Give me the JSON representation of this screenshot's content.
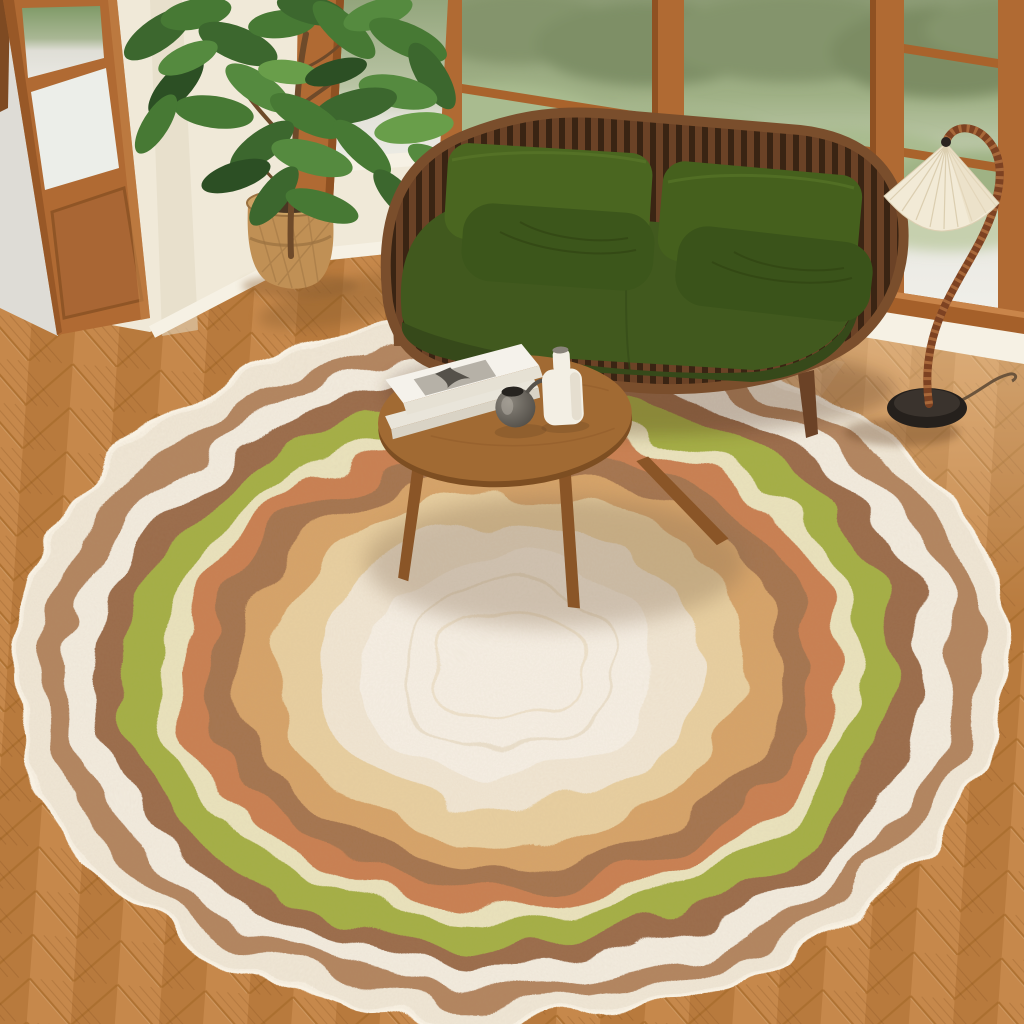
{
  "meta": {
    "description": "Top-down photo of a mid-century living room: green spindle-frame sofa by wood-framed windows, walnut oval coffee table with books and vases, pleated floor lamp, potted plant in a woven basket, open wooden french door, herringbone wood floor, and a large organic-shaped rug with wavy concentric rings in cream, brown, green and terracotta."
  },
  "palette": {
    "wall": "#f0e9d8",
    "baseboard": "#f6f1e4",
    "floor": "#c28140",
    "floor_seam": "#a96d2e",
    "wood_frame": "#b06a33",
    "wood_frame_dark": "#8f5122",
    "sill_wood": "#a5602a",
    "outdoor_path": "#dedcd6",
    "foliage_far": "#84946c",
    "foliage_bush": "#a9bb8f",
    "grass": "#7f9a67"
  },
  "rug": {
    "shape": "organic wavy oval",
    "rings": [
      {
        "name": "border-cream",
        "color": "#f0e7d6"
      },
      {
        "name": "taupe",
        "color": "#b2845f"
      },
      {
        "name": "cream",
        "color": "#f3ecdf"
      },
      {
        "name": "chestnut-brown",
        "color": "#9a6b4a"
      },
      {
        "name": "olive-green",
        "color": "#a4af44"
      },
      {
        "name": "pale-yellow",
        "color": "#eae3bd"
      },
      {
        "name": "terracotta",
        "color": "#c97f50"
      },
      {
        "name": "brown",
        "color": "#a4744e"
      },
      {
        "name": "tan-gold",
        "color": "#d6a368"
      },
      {
        "name": "buff",
        "color": "#e8cfa0"
      },
      {
        "name": "inner-cream",
        "color": "#f1e6d3"
      },
      {
        "name": "ivory-center",
        "color": "#f6efe4"
      }
    ]
  },
  "sofa": {
    "frame_color": "#6b4226",
    "slat_dark": "#3a2413",
    "rail_color": "#7a4e2c",
    "cushion_color": "#41591e",
    "cushion_shadow": "#36491a",
    "back_pillow_color": "#4a6620",
    "back_pillow_color_right": "#45601d",
    "lumbar_pillow_color": "#3c561b",
    "lumbar_pillow_color_right": "#3a531a"
  },
  "coffee_table": {
    "top_color": "#a16a33",
    "edge_color": "#7d4e22",
    "leg_color": "#8a5527",
    "items": {
      "books": {
        "cover_color": "#f5f2eb",
        "photo_color": "#b6b1a7"
      },
      "pewter_vase": {
        "color": "#55524d"
      },
      "bottle_vase": {
        "color": "#f3efe4"
      }
    }
  },
  "floor_lamp": {
    "base_color": "#25201c",
    "stem_color": "#7d4222",
    "stem_bead_color": "#a8683a",
    "shade_color": "#f2ead6"
  },
  "plant": {
    "leaf_color": "#3c672e",
    "trunk_color": "#6e4a2a",
    "basket_color": "#c09055",
    "basket_weave": "#9a7140",
    "soil_color": "#4a3623"
  }
}
